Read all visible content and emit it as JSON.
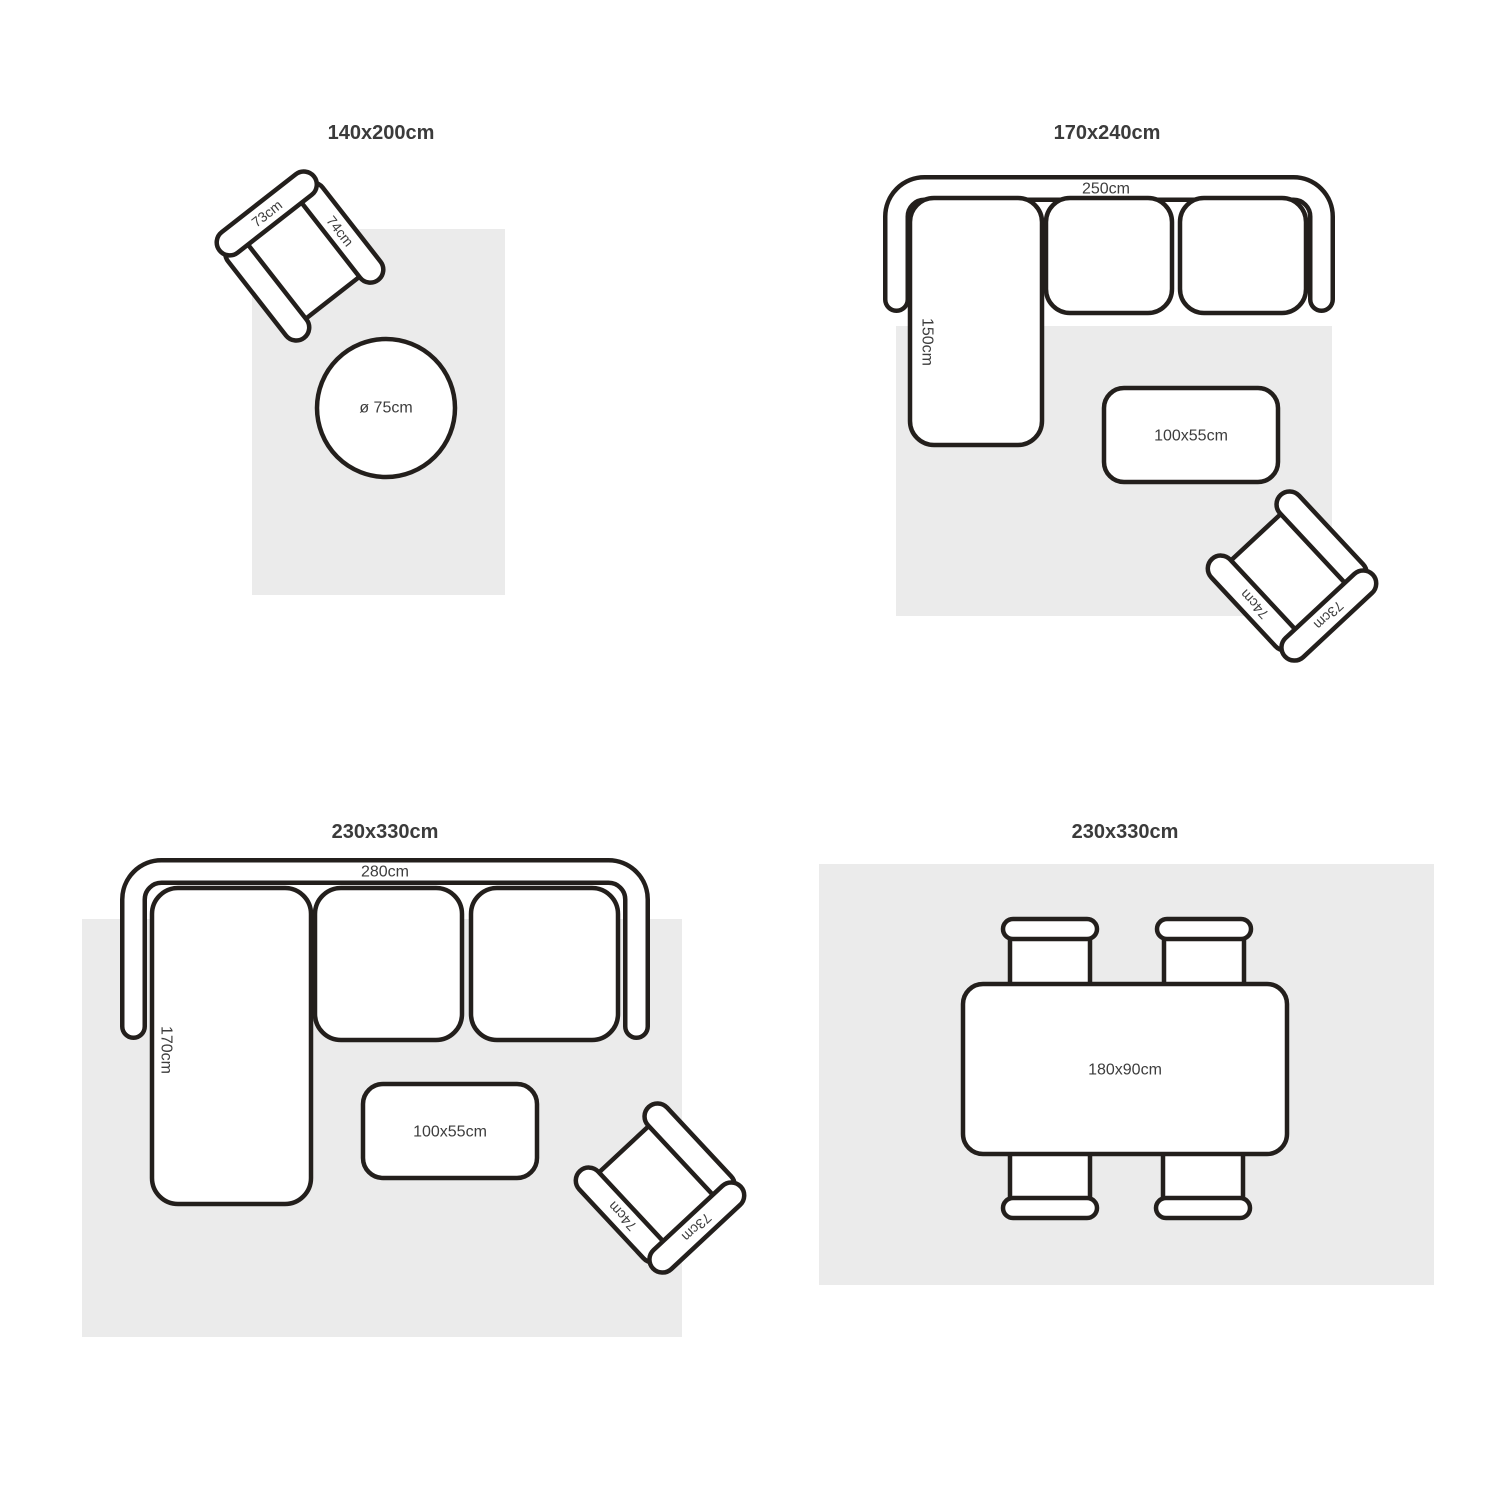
{
  "colors": {
    "outline": "#231f1c",
    "rug": "#ebebeb",
    "furniture_fill": "#ffffff",
    "title_text": "#3b3b3b",
    "label_text": "#3d3d3d"
  },
  "panels": {
    "top_left": {
      "title": "140x200cm",
      "armchair": {
        "back_width": "73cm",
        "side_depth": "74cm"
      },
      "side_table": {
        "diameter": "ø 75cm"
      }
    },
    "top_right": {
      "title": "170x240cm",
      "sofa": {
        "width": "250cm",
        "chaise_depth": "150cm"
      },
      "coffee_table": {
        "size": "100x55cm"
      },
      "armchair": {
        "back_width": "73cm",
        "side_depth": "74cm"
      }
    },
    "bottom_left": {
      "title": "230x330cm",
      "sofa": {
        "width": "280cm",
        "chaise_depth": "170cm"
      },
      "coffee_table": {
        "size": "100x55cm"
      },
      "armchair": {
        "back_width": "73cm",
        "side_depth": "74cm"
      }
    },
    "bottom_right": {
      "title": "230x330cm",
      "dining_table": {
        "size": "180x90cm"
      }
    }
  }
}
